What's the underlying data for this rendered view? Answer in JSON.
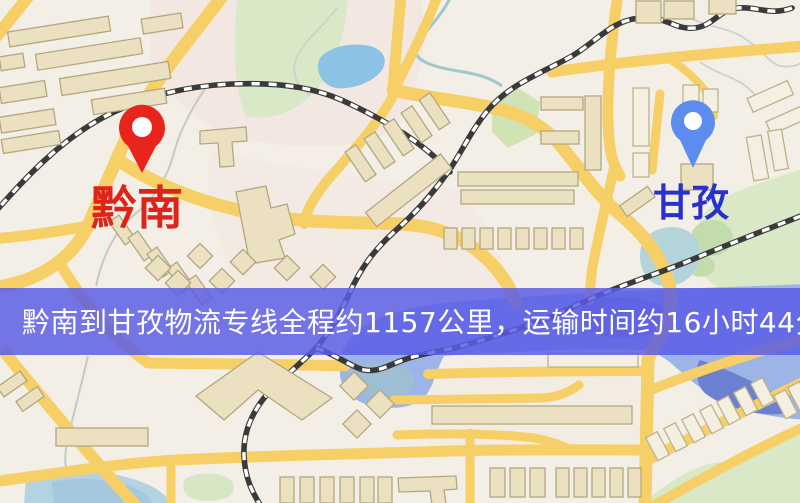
{
  "route": {
    "origin": {
      "name": "黔南",
      "marker": "red-pin",
      "marker_color": "#e7251d",
      "marker_hole_color": "#ffffff",
      "label_color": "#de231b"
    },
    "destination": {
      "name": "甘孜",
      "marker": "blue-pin",
      "marker_color": "#5b8cee",
      "marker_hole_color": "#ffffff",
      "label_color": "#2931cd"
    },
    "banner": {
      "text": "黔南到甘孜物流专线全程约1157公里，运输时间约16小时44分钟.",
      "distance_text": "约1157公里",
      "duration_text": "约16小时44分钟",
      "bg_color": "#5b5ce6",
      "text_color": "#ffffff"
    }
  },
  "map": {
    "type": "street-map",
    "legend": {
      "road_color": "#f6cf67",
      "building_color": "#ebe1c1",
      "water_color": "#9db4e6",
      "park_color": "#d9e8c6",
      "railway_style": "black-white-dashed"
    }
  }
}
